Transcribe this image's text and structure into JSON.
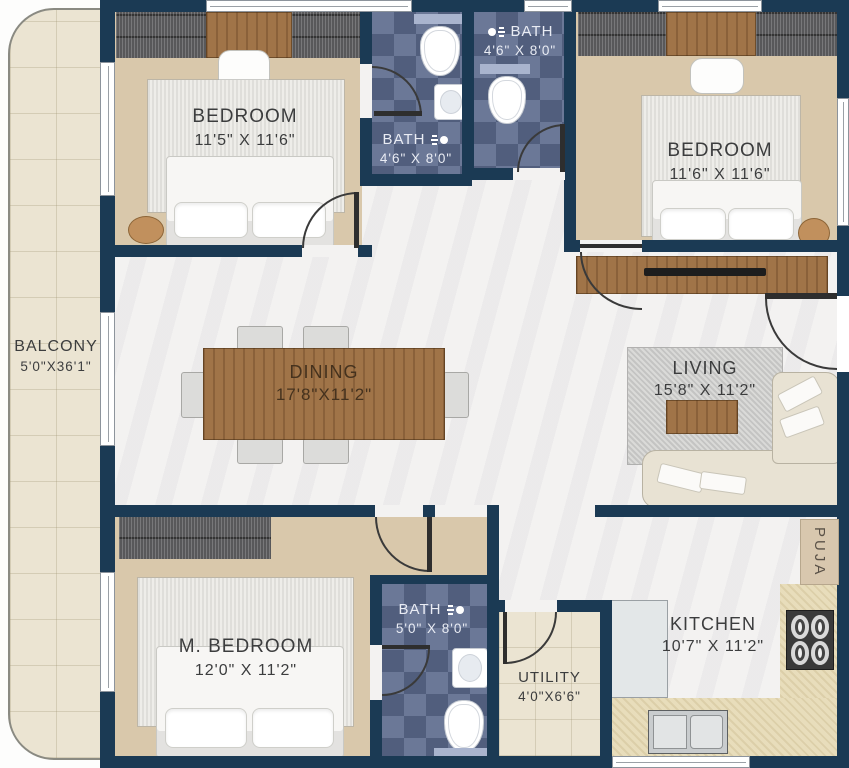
{
  "rooms": {
    "balcony": {
      "label": "BALCONY",
      "dims": "5'0\"X36'1\""
    },
    "bedroom_top_left": {
      "label": "BEDROOM",
      "dims": "11'5\" X 11'6\""
    },
    "bath_top_left": {
      "label": "BATH",
      "dims": "4'6\" X 8'0\""
    },
    "bath_top_right": {
      "label": "BATH",
      "dims": "4'6\" X 8'0\""
    },
    "bedroom_top_right": {
      "label": "BEDROOM",
      "dims": "11'6\" X 11'6\""
    },
    "dining": {
      "label": "DINING",
      "dims": "17'8\"X11'2\""
    },
    "living": {
      "label": "LIVING",
      "dims": "15'8\" X 11'2\""
    },
    "master_bedroom": {
      "label": "M. BEDROOM",
      "dims": "12'0\" X 11'2\""
    },
    "bath_master": {
      "label": "BATH",
      "dims": "5'0\" X 8'0\""
    },
    "utility": {
      "label": "UTILITY",
      "dims": "4'0\"X6'6\""
    },
    "kitchen": {
      "label": "KITCHEN",
      "dims": "10'7\" X 11'2\""
    },
    "puja": {
      "label": "PUJA"
    }
  },
  "colors": {
    "wall": "#1b3a54",
    "bath_tile": "#606e8f",
    "wood_floor": "#d9c8ab",
    "marble_floor": "#f3f2f1",
    "balcony_floor": "#ebe4d2",
    "kitchen_counter": "#e8ddbb",
    "furniture_wood": "#a07448",
    "label_text": "#3c3d3e",
    "bath_label_text": "#e9ecf4"
  }
}
